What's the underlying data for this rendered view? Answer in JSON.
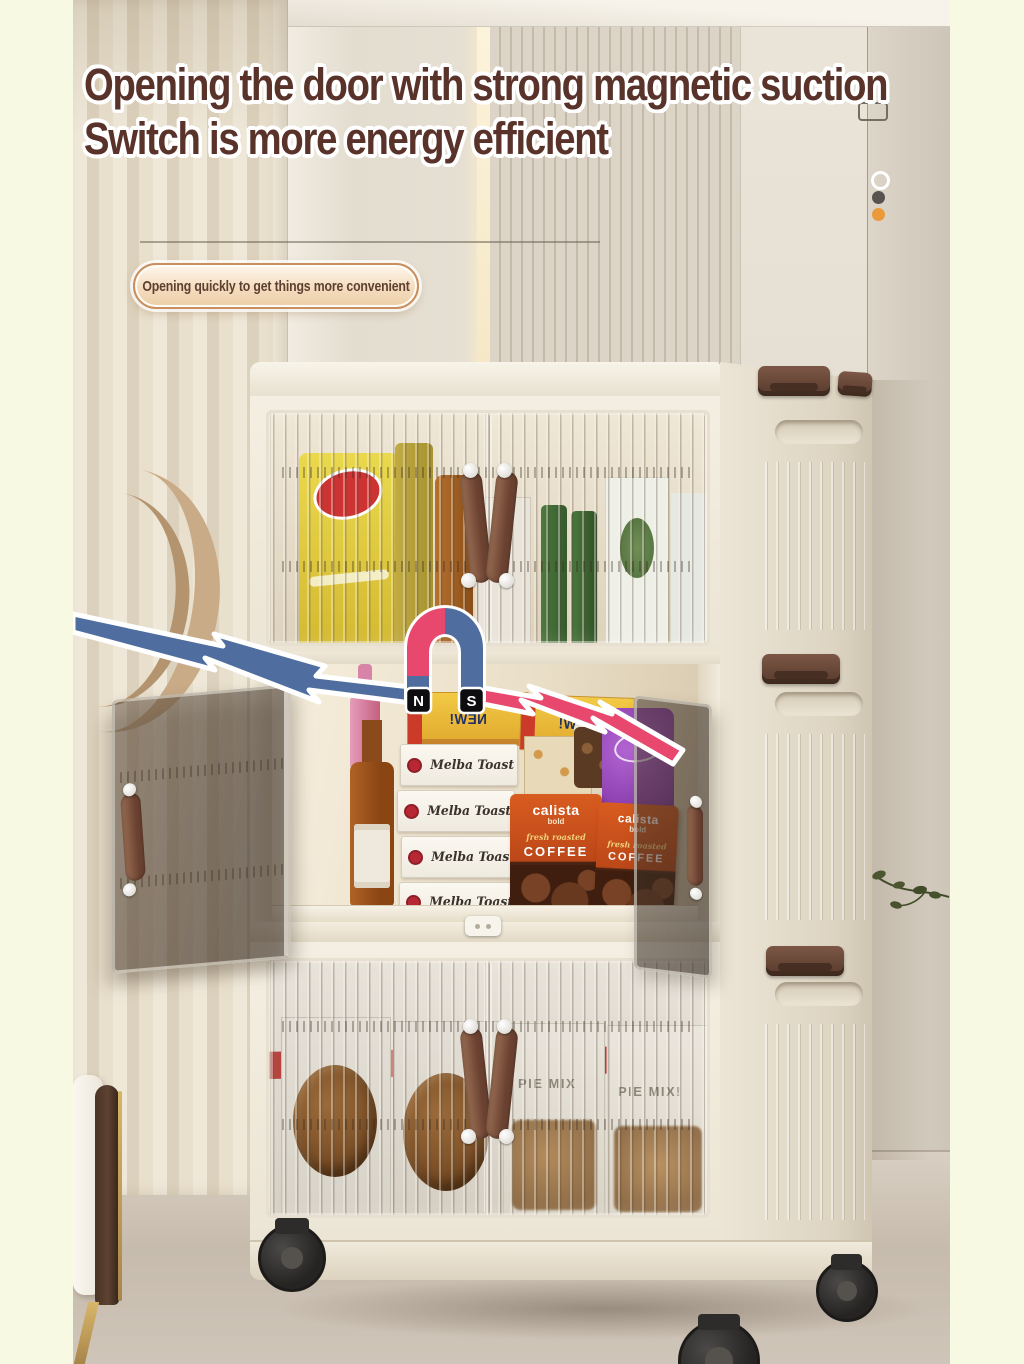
{
  "scene": {
    "margin_color": "#f8f9e2"
  },
  "headline": {
    "line1": "Opening the door with strong magnetic suction",
    "line2": "Switch is more energy efficient",
    "text_color": "#59322a",
    "outline_color": "#ffffff"
  },
  "callout": {
    "text": "Opening quickly to get things more convenient",
    "text_color": "#5d4032",
    "border_color": "#c98f5e"
  },
  "magnet": {
    "north_label": "N",
    "south_label": "S",
    "pink": "#e8486e",
    "blue": "#4f6e9f",
    "badge_bg": "#0d0d10"
  },
  "cabinet": {
    "tiers": 3,
    "body_color": "#f3eee1",
    "handle_color": "#7a5140",
    "clip_color": "#6e4a38",
    "wheel_color": "#2b2927"
  },
  "products": {
    "melba_label": "Melba Toast",
    "new_label": "NEW!",
    "coffee_brand": "calista",
    "coffee_weight": "bold",
    "coffee_roast": "fresh roasted",
    "coffee_label": "COFFEE",
    "pie_red_label": "PIE MIX",
    "pie_center_label": "PIE MIX",
    "pie_right_label": "PIE MIX!"
  },
  "wall_accents": {
    "dot_colors": [
      "#ffffff",
      "#57534f",
      "#e99b3c"
    ]
  }
}
